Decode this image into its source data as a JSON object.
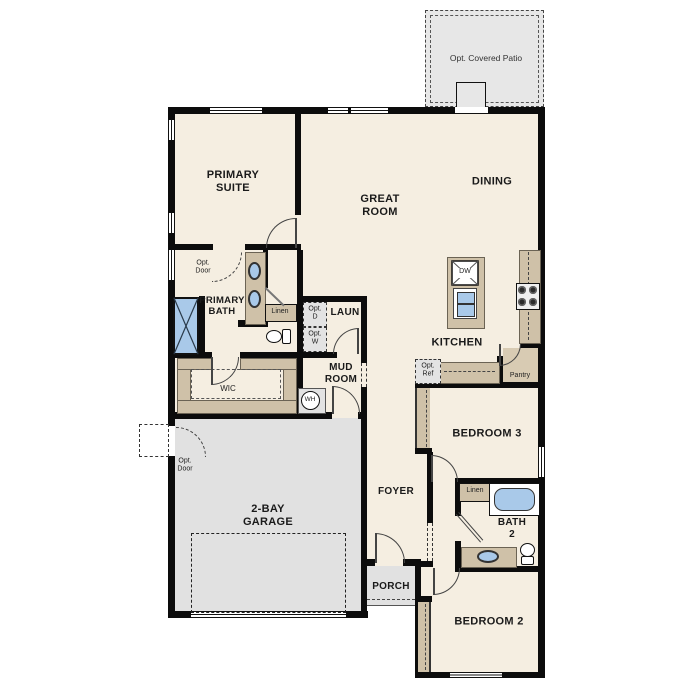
{
  "patio": {
    "label": "Opt. Covered Patio"
  },
  "rooms": {
    "primary_suite": "PRIMARY SUITE",
    "great_room": "GREAT ROOM",
    "dining": "DINING",
    "kitchen": "KITCHEN",
    "primary_bath": "PRIMARY BATH",
    "laundry": "LAUN",
    "mud_room": "MUD ROOM",
    "wic": "WIC",
    "foyer": "FOYER",
    "porch": "PORCH",
    "garage": "2-BAY GARAGE",
    "bedroom2": "BEDROOM 2",
    "bedroom3": "BEDROOM 3",
    "bath2": "BATH 2",
    "pantry": "Pantry"
  },
  "features": {
    "opt_door": "Opt. Door",
    "linen": "Linen",
    "opt_dryer": "Opt. D",
    "opt_washer": "Opt. W",
    "opt_refrigerator": "Opt. Ref",
    "dishwasher": "DW",
    "water_heater": "WH"
  },
  "colors": {
    "floor": "#f5eee1",
    "wall": "#0c0c0c",
    "casework_tan": "#cfc1a8",
    "concrete_gray": "#e2e2e2",
    "fixture_blue": "#a9c9e9"
  }
}
